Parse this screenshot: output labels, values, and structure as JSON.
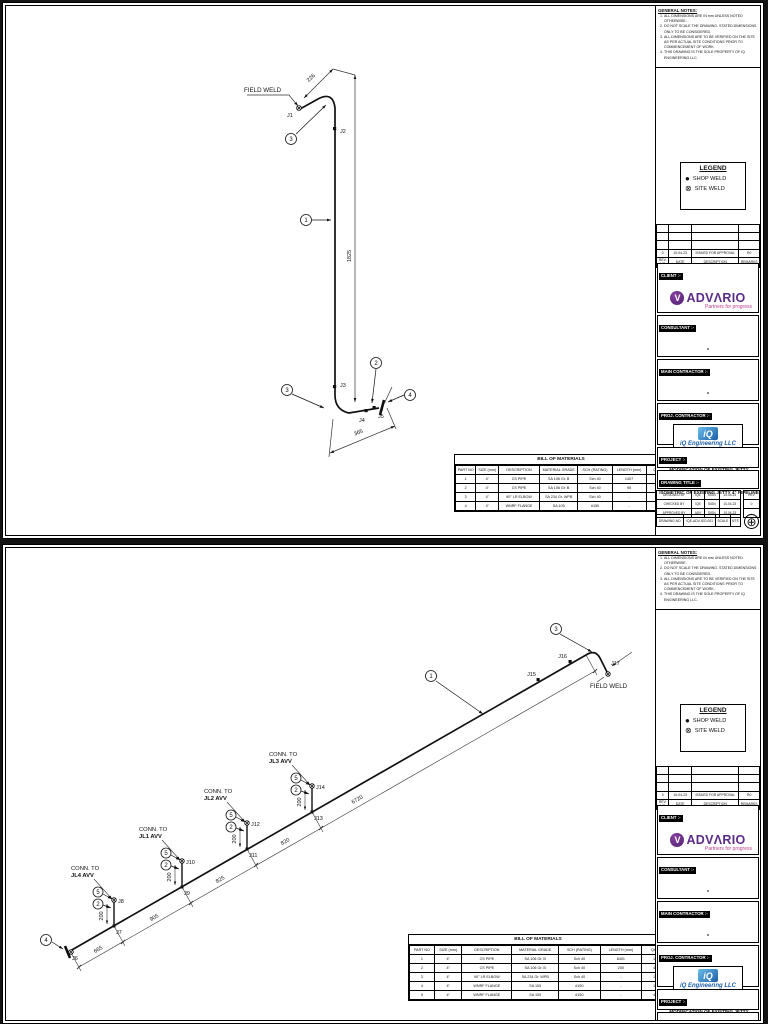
{
  "notes": {
    "title": "GENERAL NOTES:",
    "items": [
      "ALL DIMENSIONS ARE IN mm UNLESS NOTED OTHERWISE.",
      "DO NOT SCALE THE DRAWING. STATED DIMENSIONS ONLY TO BE CONSIDERED.",
      "ALL DIMENSIONS ARE TO BE VERIFIED ON THE SITE AS PER ACTUAL SITE CONDITIONS PRIOR TO COMMENCEMENT OF WORK.",
      "THIS DRAWING IS THE SOLE PROPERTY OF IQ ENGINEERING LLC."
    ]
  },
  "legend": {
    "title": "LEGEND",
    "shop_icon": "●",
    "shop_weld": "SHOP WELD",
    "site_icon": "⊗",
    "site_weld": "SITE WELD"
  },
  "revisions": {
    "rows": [
      [
        "",
        "",
        "",
        ""
      ],
      [
        "",
        "",
        "",
        ""
      ],
      [
        "",
        "",
        "",
        ""
      ],
      [
        "0",
        "10-04-23",
        "ISSUED FOR APPROVAL",
        "R0"
      ],
      [
        "REV. NO",
        "DATE",
        "DESCRIPTION",
        "REMARKS"
      ]
    ]
  },
  "tb": {
    "client_label": "CLIENT :-",
    "advario_brand": "ADVΛRIO",
    "advario_mark": "V",
    "advario_tagline": "Partners for progress",
    "advario_purple": "#5B2C86",
    "advario_magenta": "#C13C8C",
    "consultant_label": "CONSULTANT :-",
    "consultant_value": "-",
    "main_contractor_label": "MAIN CONTRACTOR :-",
    "main_contractor_value": "-",
    "proj_contractor_label": "PROJ. CONTRACTOR :-",
    "iq_mark": "iQ",
    "iq_name": "iQ Engineering LLC",
    "iq_blue": "#1B5FA8",
    "project_label": "PROJECT :-",
    "project_value": "MODIFICATION OF EXISTING JETTY PIPELINES",
    "drawing_title_label": "DRAWING TITLE :-",
    "drawing_title_value": "ISOMETRIC OF EXISTING JETTY 4\" PIPELINE",
    "sign_rows": [
      [
        "DESIGNED BY",
        "IQE",
        "SIGN",
        "10-04-23"
      ],
      [
        "CHECKED BY",
        "IQE",
        "SIGN",
        "10-04-23"
      ],
      [
        "APPROVED BY",
        "ADV",
        "SIGN",
        "10-04-23"
      ]
    ],
    "rev_col": [
      [
        "REV"
      ],
      [
        "0"
      ],
      [
        "-"
      ]
    ],
    "footer_row": [
      [
        "DRAWING NO.",
        "IQE-ADV-ISO-001",
        "SCALE",
        "NTS"
      ]
    ],
    "compass_icon": "⊕"
  },
  "s1": {
    "field_weld": "FIELD WELD",
    "j1": "J1",
    "j2": "J2",
    "j3": "J3",
    "j4": "J4",
    "j5": "J5",
    "b3a": "3",
    "b1": "1",
    "b3b": "3",
    "b2": "2",
    "b4": "4",
    "d226": "226",
    "d1825": "1825",
    "d365": "365",
    "bom": {
      "title": "BILL OF MATERIALS",
      "rows": [
        [
          "PART NO",
          "SIZE (mm)",
          "DESCRIPTION",
          "MATERIAL GRADE",
          "SCH (RATING)",
          "LENGTH (mm)",
          "Qty"
        ],
        [
          "1",
          "4\"",
          "CS PIPE",
          "SA 106 Gr. B",
          "Sch 40",
          "1407",
          "1"
        ],
        [
          "2",
          "4\"",
          "CS PIPE",
          "SA 106 Gr. B",
          "Sch 40",
          "95",
          "1"
        ],
        [
          "3",
          "4\"",
          "90° LR ELBOW",
          "SA 234 Gr. WPB",
          "Sch 40",
          "-",
          "2"
        ],
        [
          "4",
          "4\"",
          "WNRF FLANGE",
          "SA 105",
          "#150",
          "-",
          "1"
        ]
      ]
    }
  },
  "s2": {
    "field_weld": "FIELD WELD",
    "j6": "J6",
    "j7": "J7",
    "j8": "J8",
    "j9": "J9",
    "j10": "J10",
    "j11": "J11",
    "j12": "J12",
    "j13": "J13",
    "j14": "J14",
    "j15": "J15",
    "j16": "J16",
    "j17": "J17",
    "b4": "4",
    "b1": "1",
    "b3": "3",
    "b5": "5",
    "b2": "2",
    "conn_line1": "CONN. TO",
    "jl4": "JL4 AVV",
    "jl1": "JL1 AVV",
    "jl2": "JL2 AVV",
    "jl3": "JL3 AVV",
    "d665": "665",
    "d905": "905",
    "d825": "825",
    "d820": "820",
    "d6720": "6720",
    "d200": "200",
    "bom": {
      "title": "BILL OF MATERIALS",
      "rows": [
        [
          "PART NO",
          "SIZE (mm)",
          "DESCRIPTION",
          "MATERIAL GRADE",
          "SCH (RATING)",
          "LENGTH (mm)",
          "Qty"
        ],
        [
          "1",
          "4\"",
          "CS PIPE",
          "SA 106 Gr. B",
          "Sch 40",
          "8401",
          "1"
        ],
        [
          "2",
          "4\"",
          "CS PIPE",
          "SA 106 Gr. B",
          "Sch 40",
          "200",
          "4"
        ],
        [
          "3",
          "4\"",
          "90° LR ELBOW",
          "SA 234 Gr. WPB",
          "Sch 40",
          "-",
          "1"
        ],
        [
          "4",
          "4\"",
          "WNRF FLANGE",
          "SA 105",
          "#150",
          "-",
          "1"
        ],
        [
          "5",
          "4\"",
          "WNRF FLANGE",
          "SA 105",
          "#150",
          "-",
          "4"
        ]
      ]
    }
  }
}
